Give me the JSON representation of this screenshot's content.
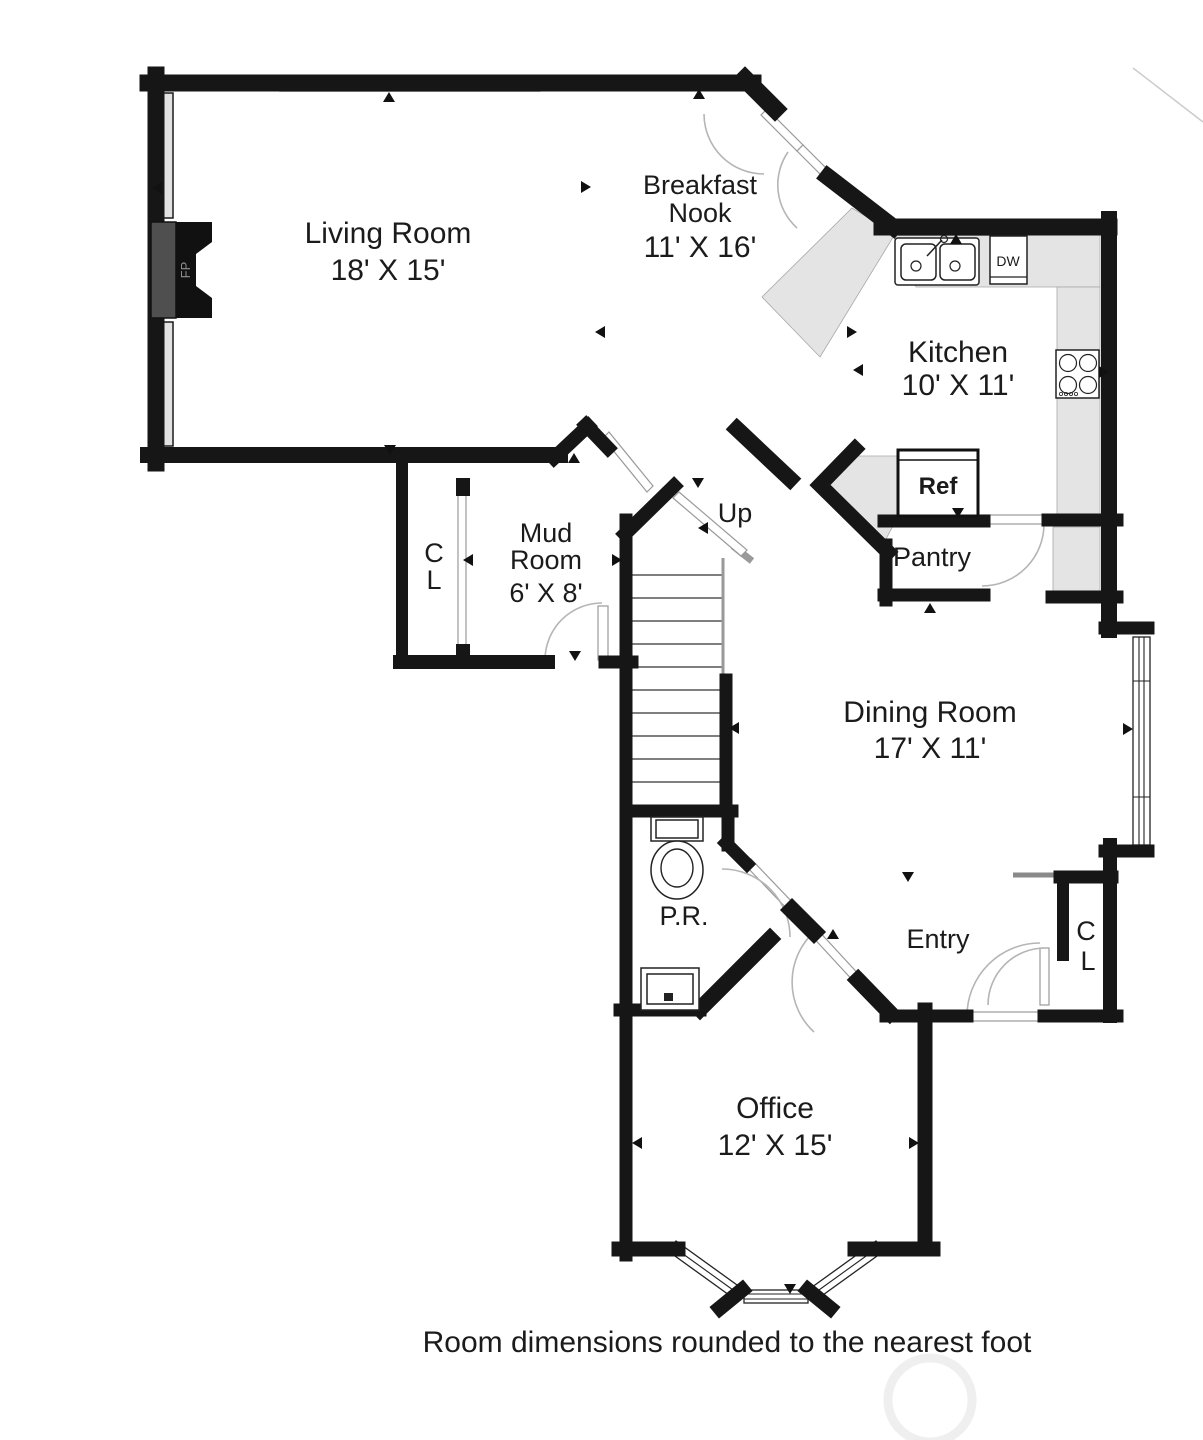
{
  "plan": {
    "note": "Room dimensions rounded to the nearest foot",
    "rooms": {
      "living": {
        "label": "Living Room",
        "dims": "18' X 15'"
      },
      "breakfast": {
        "line1": "Breakfast",
        "line2": "Nook",
        "dims": "11' X 16'"
      },
      "kitchen": {
        "label": "Kitchen",
        "dims": "10' X 11'"
      },
      "mud": {
        "line1": "Mud",
        "line2": "Room",
        "dims": "6' X 8'"
      },
      "closet_mud": {
        "line1": "C",
        "line2": "L"
      },
      "stairs": {
        "label": "Up"
      },
      "pantry": {
        "label": "Pantry"
      },
      "dining": {
        "label": "Dining Room",
        "dims": "17' X 11'"
      },
      "powder": {
        "label": "P.R."
      },
      "entry": {
        "label": "Entry"
      },
      "closet_entry": {
        "line1": "C",
        "line2": "L"
      },
      "office": {
        "label": "Office",
        "dims": "12' X 15'"
      }
    },
    "fixtures": {
      "fireplace": "FP",
      "dishwasher": "DW",
      "refrigerator": "Ref"
    },
    "colors": {
      "wall": "#161616",
      "counter": "#e4e4e4",
      "window_pane": "#e2e2e2",
      "door_arc": "#b5b5b5",
      "firebox": "#4f4f4f",
      "watermark": "#efefef"
    }
  }
}
